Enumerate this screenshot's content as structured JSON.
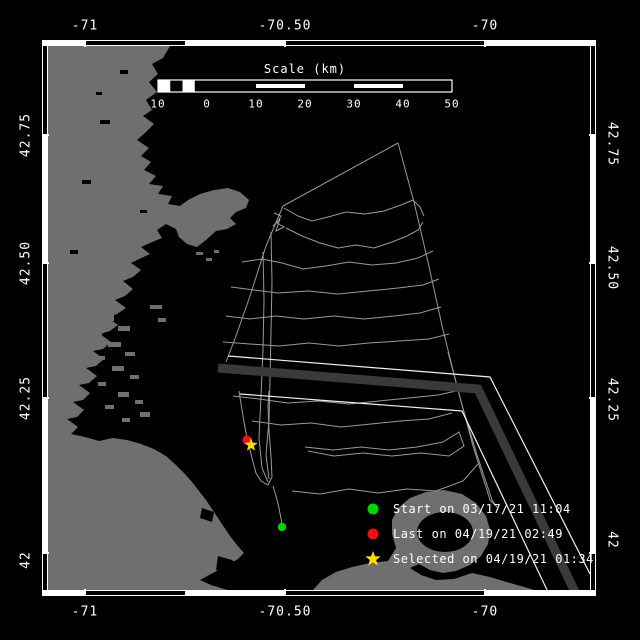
{
  "map": {
    "axis": {
      "top": [
        "-71",
        "-70.50",
        "-70"
      ],
      "bottom": [
        "-71",
        "-70.50",
        "-70"
      ],
      "left": [
        "42.75",
        "42.50",
        "42.25",
        "42"
      ],
      "right": [
        "42.75",
        "42.50",
        "42.25",
        "42"
      ]
    },
    "scale_bar": {
      "title": "Scale (km)",
      "ticks": [
        "10",
        "0",
        "10",
        "20",
        "30",
        "40",
        "50"
      ]
    },
    "legend": {
      "items": [
        {
          "marker": "start-dot",
          "color": "#00d400",
          "label": "Start on 03/17/21 11:04"
        },
        {
          "marker": "last-dot",
          "color": "#ee1111",
          "label": "Last on 04/19/21 02:49"
        },
        {
          "marker": "selected-star",
          "color": "#ffe000",
          "label": "Selected on 04/19/21 01:34"
        }
      ]
    },
    "markers": {
      "start": {
        "x": 282,
        "y": 527
      },
      "last": {
        "x": 247,
        "y": 440
      },
      "selected": {
        "x": 251,
        "y": 445
      }
    },
    "colors": {
      "background": "#000000",
      "water": "#000000",
      "land": "#6f6f6f",
      "track": "#9a9a9a",
      "separation_zone": "#3a3a3a",
      "lane_boundary": "#f0f0f0",
      "frame": "#ffffff"
    }
  }
}
